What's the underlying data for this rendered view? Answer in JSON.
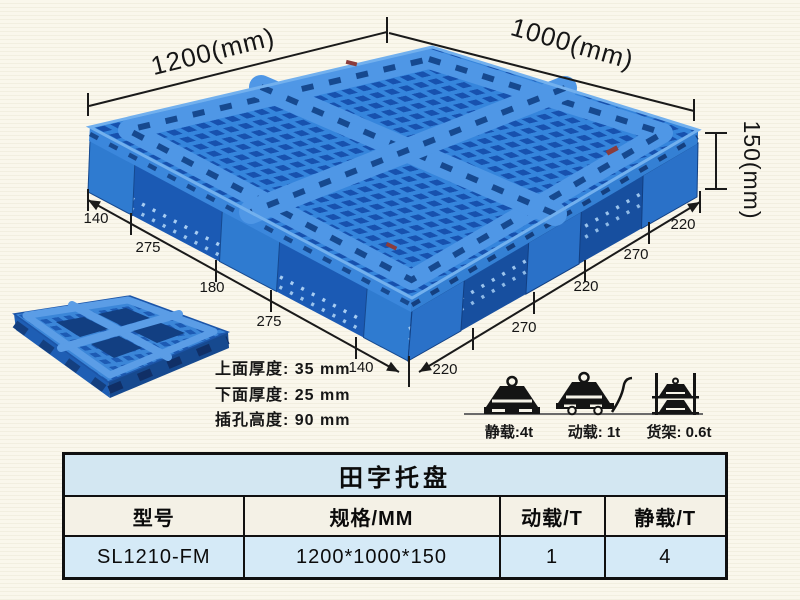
{
  "illustration": {
    "dims": {
      "top_left": "1200(mm)",
      "top_right": "1000(mm)",
      "height": "150(mm)",
      "left_chain": [
        "140",
        "275",
        "180",
        "275",
        "140"
      ],
      "right_chain": [
        "220",
        "270",
        "220",
        "270",
        "220"
      ]
    },
    "specs": [
      "上面厚度: 35 mm",
      "下面厚度: 25 mm",
      "插孔高度: 90 mm"
    ],
    "loads": [
      {
        "icon": "static-load-weight-icon",
        "label": "静载:4t"
      },
      {
        "icon": "dynamic-load-trolley-icon",
        "label": "动载: 1t"
      },
      {
        "icon": "rack-load-shelf-icon",
        "label": "货架: 0.6t"
      }
    ],
    "colors": {
      "pallet_blue": "#3585dc",
      "pallet_dark_blue": "#1751ae",
      "band_blue": "#4f97e6",
      "dim_line": "#1a1a1a"
    }
  },
  "table": {
    "title": "田字托盘",
    "headers": [
      "型号",
      "规格/MM",
      "动载/T",
      "静载/T"
    ],
    "rows": [
      [
        "SL1210-FM",
        "1200*1000*150",
        "1",
        "4"
      ]
    ],
    "colors": {
      "title_bg": "#d3e7f2",
      "header_bg": "#f4f1e6",
      "row_bg": "#d5eaf7",
      "border": "#101010"
    }
  }
}
